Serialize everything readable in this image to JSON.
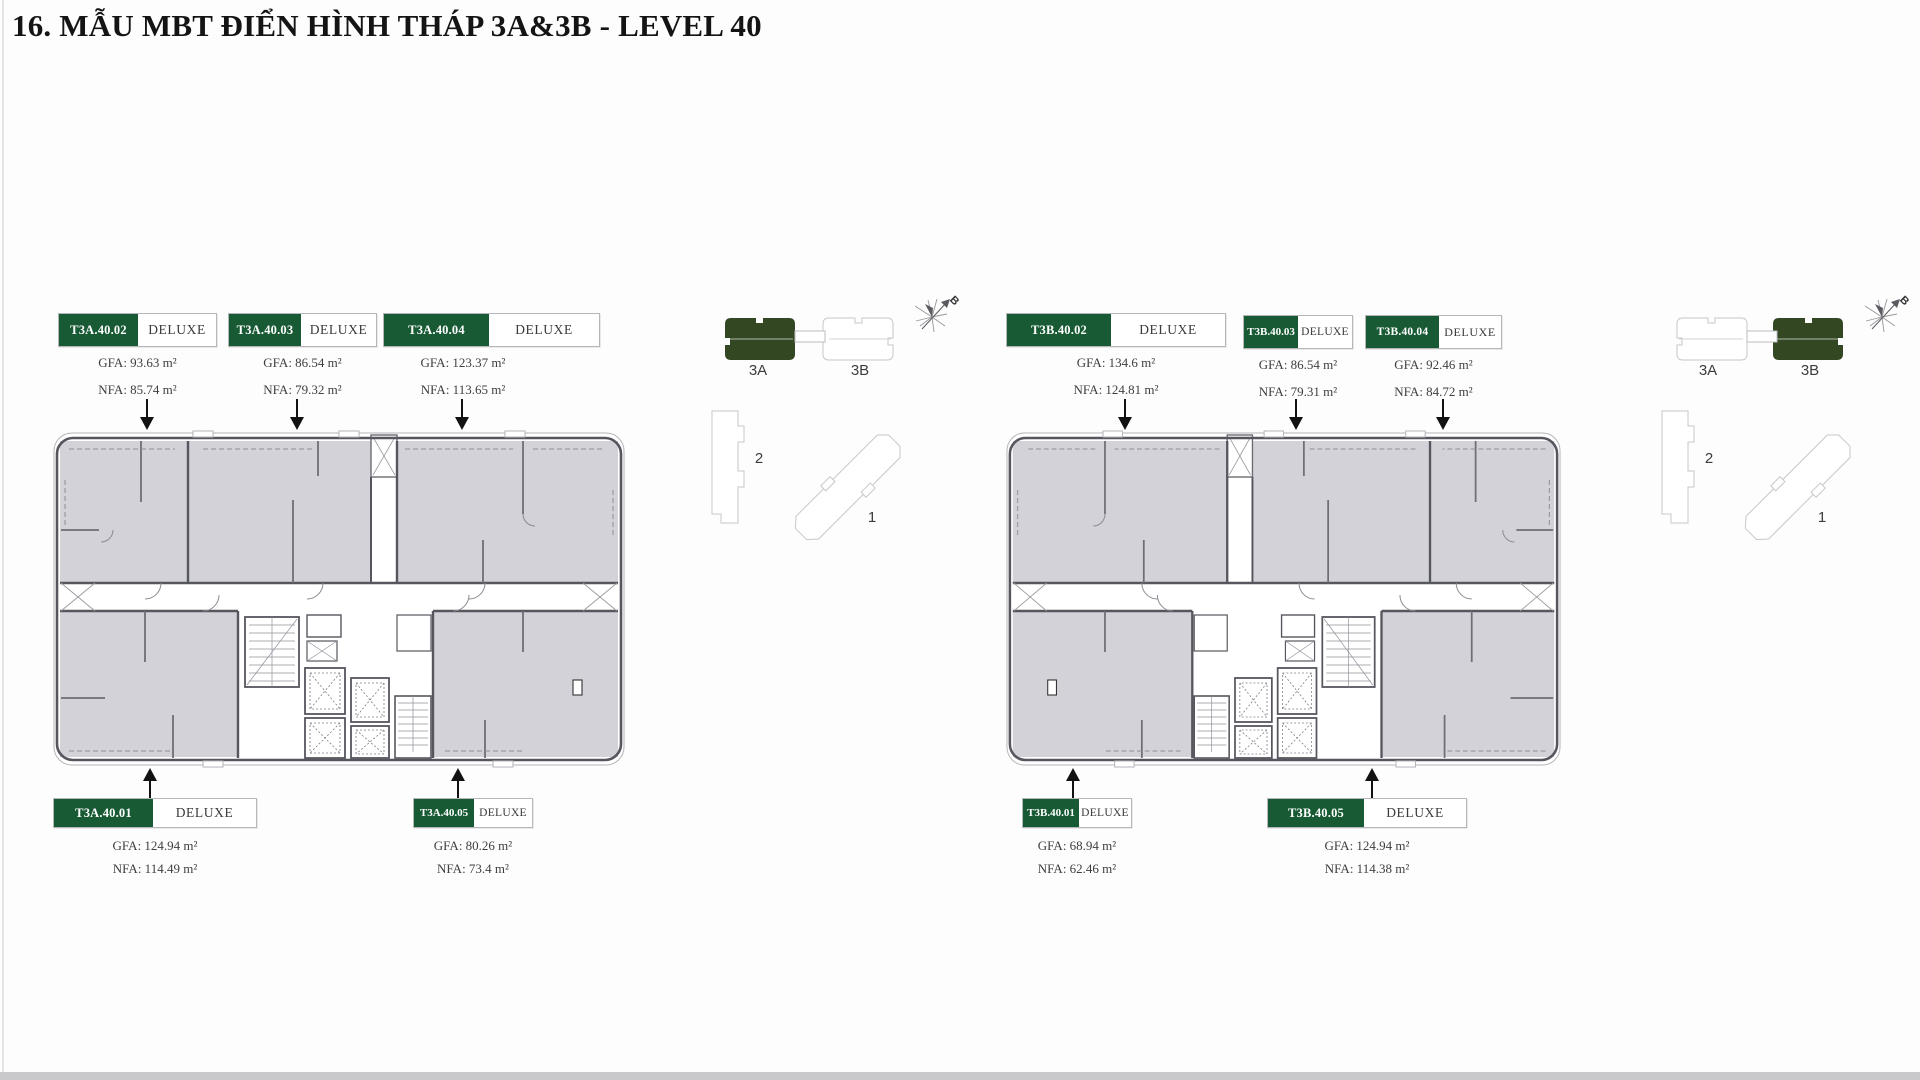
{
  "title": "16. MẪU MBT ĐIỂN HÌNH THÁP 3A&3B - LEVEL 40",
  "colors": {
    "unit_green": "#175a34",
    "kp_green": "#334723",
    "wall_gray": "#56565e",
    "room_fill": "#d2d2d8"
  },
  "tower_3a": {
    "name": "3A",
    "top_units": [
      {
        "code": "T3A.40.02",
        "type": "DELUXE",
        "gfa": "GFA: 93.63 m²",
        "nfa": "NFA: 85.74 m²"
      },
      {
        "code": "T3A.40.03",
        "type": "DELUXE",
        "gfa": "GFA: 86.54 m²",
        "nfa": "NFA: 79.32 m²"
      },
      {
        "code": "T3A.40.04",
        "type": "DELUXE",
        "gfa": "GFA: 123.37 m²",
        "nfa": "NFA: 113.65 m²"
      }
    ],
    "bottom_units": [
      {
        "code": "T3A.40.01",
        "type": "DELUXE",
        "gfa": "GFA: 124.94 m²",
        "nfa": "NFA: 114.49 m²"
      },
      {
        "code": "T3A.40.05",
        "type": "DELUXE",
        "gfa": "GFA: 80.26 m²",
        "nfa": "NFA: 73.4 m²"
      }
    ]
  },
  "tower_3b": {
    "name": "3B",
    "top_units": [
      {
        "code": "T3B.40.02",
        "type": "DELUXE",
        "gfa": "GFA: 134.6 m²",
        "nfa": "NFA: 124.81 m²"
      },
      {
        "code": "T3B.40.03",
        "type": "DELUXE",
        "gfa": "GFA: 86.54 m²",
        "nfa": "NFA: 79.31 m²"
      },
      {
        "code": "T3B.40.04",
        "type": "DELUXE",
        "gfa": "GFA: 92.46 m²",
        "nfa": "NFA: 84.72 m²"
      }
    ],
    "bottom_units": [
      {
        "code": "T3B.40.01",
        "type": "DELUXE",
        "gfa": "GFA: 68.94 m²",
        "nfa": "NFA: 62.46 m²"
      },
      {
        "code": "T3B.40.05",
        "type": "DELUXE",
        "gfa": "GFA: 124.94 m²",
        "nfa": "NFA: 114.38 m²"
      }
    ]
  },
  "keyplan_left": {
    "tower_a": "3A",
    "tower_b": "3B",
    "highlighted": "3A",
    "zone_2": "2",
    "zone_1": "1",
    "compass_label": "B"
  },
  "keyplan_right": {
    "tower_a": "3A",
    "tower_b": "3B",
    "highlighted": "3B",
    "zone_2": "2",
    "zone_1": "1",
    "compass_label": "B"
  }
}
